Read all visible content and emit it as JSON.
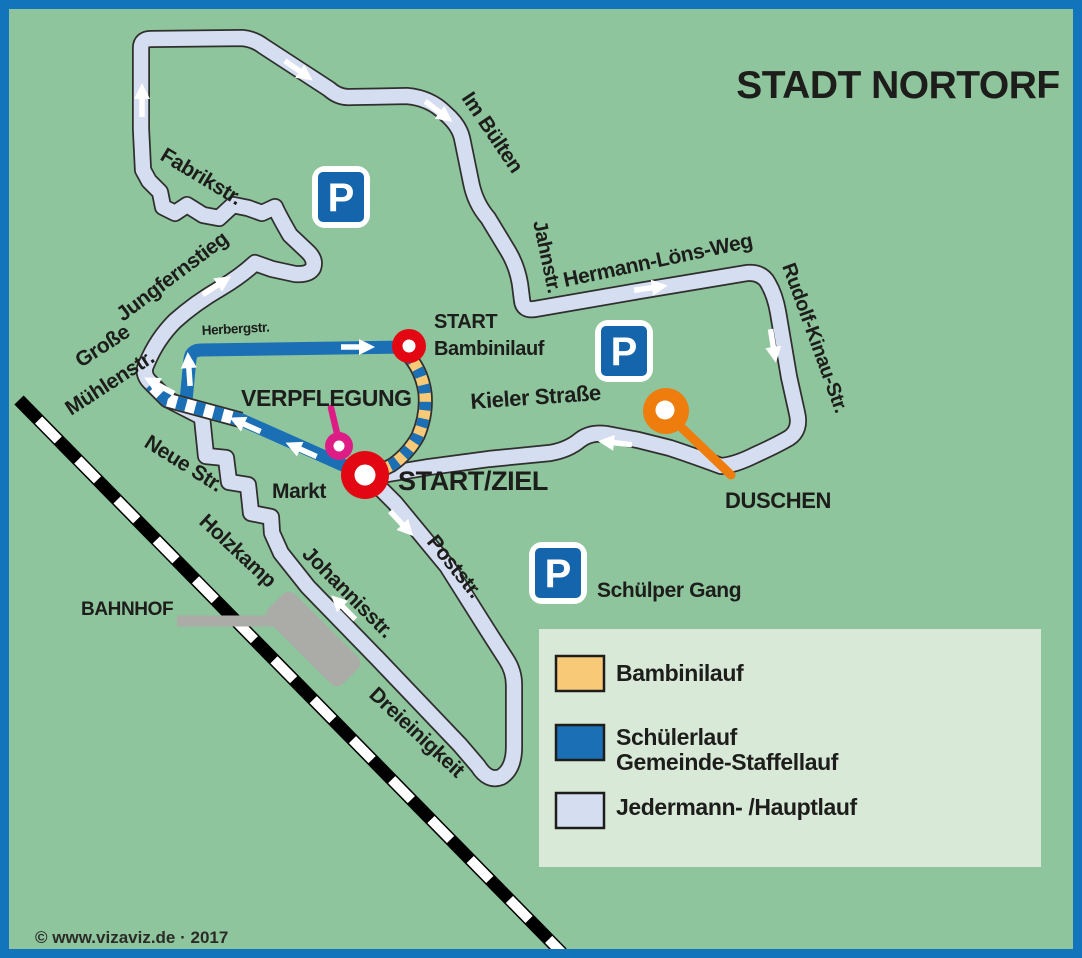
{
  "title": "STADT NORTORF",
  "copyright": "© www.vizaviz.de · 2017",
  "colors": {
    "bg": "#8EC59D",
    "border": "#1275BC",
    "ink": "#1D1D1B",
    "casing": "#2F2F2D",
    "hauptlauf": "#D5DDF0",
    "schueler": "#1A6FB5",
    "bambini": "#F8C977",
    "white": "#FFFFFF",
    "railblack": "#000000",
    "railwhite": "#FFFFFF",
    "gray": "#ABABA7",
    "red": "#E30613",
    "magenta": "#DE1C86",
    "orange": "#EE7D0E",
    "pblue": "#1565AC",
    "legendbg": "#D9E9D8"
  },
  "streets": {
    "fabrikstr": "Fabrikstr.",
    "jungfernstieg": "Jungfernstieg",
    "grosse_muehlenstr_line1": "Große",
    "grosse_muehlenstr_line2": "Mühlenstr.",
    "herbergstr": "Herbergstr.",
    "neue_str": "Neue Str.",
    "holzkamp": "Holzkamp",
    "johannisstr": "Johannisstr.",
    "poststr": "Poststr.",
    "dreieinigkeit": "Dreieinigkeit",
    "im_buelten": "Im Bülten",
    "jahnstr": "Jahnstr.",
    "hermann_loens_weg": "Hermann-Löns-Weg",
    "rudolf_kinau_str": "Rudolf-Kinau-Str.",
    "kieler_strasse": "Kieler Straße",
    "markt": "Markt",
    "schuelper_gang": "Schülper Gang"
  },
  "markers": {
    "start_ziel": "START/ZIEL",
    "start_bambinilauf_line1": "START",
    "start_bambinilauf_line2": "Bambinilauf",
    "verpflegung": "VERPFLEGUNG",
    "duschen": "DUSCHEN",
    "bahnhof": "BAHNHOF",
    "parking_letter": "P"
  },
  "legend": {
    "items": [
      {
        "label": "Bambinilauf",
        "color": "#F8C977"
      },
      {
        "label_line1": "Schülerlauf",
        "label_line2": "Gemeinde-Staffellauf",
        "color": "#1A6FB5"
      },
      {
        "label": "Jedermann- /Hauptlauf",
        "color": "#D5DDF0"
      }
    ]
  }
}
